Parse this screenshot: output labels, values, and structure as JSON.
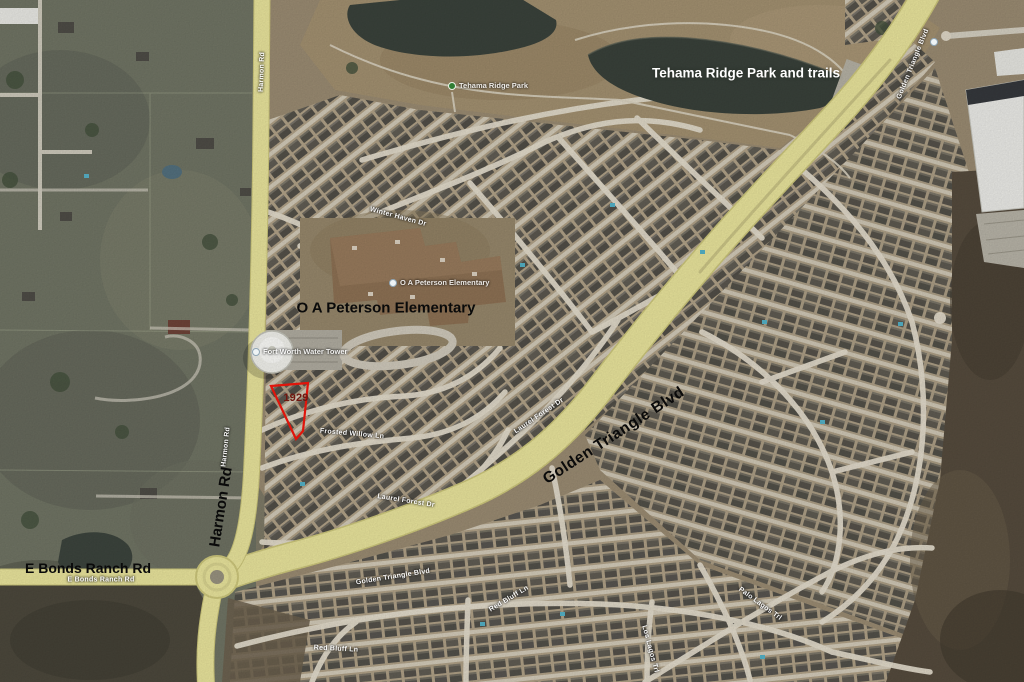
{
  "map": {
    "annotations": {
      "park_title": "Tehama Ridge Park and trails",
      "school_title": "O A Peterson Elementary",
      "boulevard_title": "Golden Triangle Blvd",
      "harmon_title": "Harmon Rd",
      "bonds_title": "E Bonds Ranch Rd",
      "parcel_number": "1929"
    },
    "poi_labels": {
      "park": "Tehama Ridge Park",
      "school": "O A Peterson Elementary",
      "water_tower": "Fort Worth Water Tower"
    },
    "street_labels": {
      "winter_haven": "Winter Haven Dr",
      "frosted_willow": "Frosted Willow Ln",
      "laurel_forest_upper": "Laurel Forest Dr",
      "laurel_forest_lower": "Laurel Forest Dr",
      "golden_triangle_on_road": "Golden Triangle Blvd",
      "golden_triangle_on_road_ne": "Golden Triangle Blvd",
      "harmon_on_road": "Harmon Rd",
      "harmon_on_road_top": "Harmon Rd",
      "bonds_on_road": "E Bonds Ranch Rd",
      "red_bluff_west": "Red Bluff Ln",
      "red_bluff_east": "Red Bluff Ln",
      "palo_lagos": "Palo Lagos Trl",
      "los_lagos": "Los Lagos Trl"
    },
    "colors": {
      "major_road_yellow": "#e9e49c",
      "parcel_outline_red": "#e0150b",
      "parcel_number_red": "#701710"
    }
  }
}
